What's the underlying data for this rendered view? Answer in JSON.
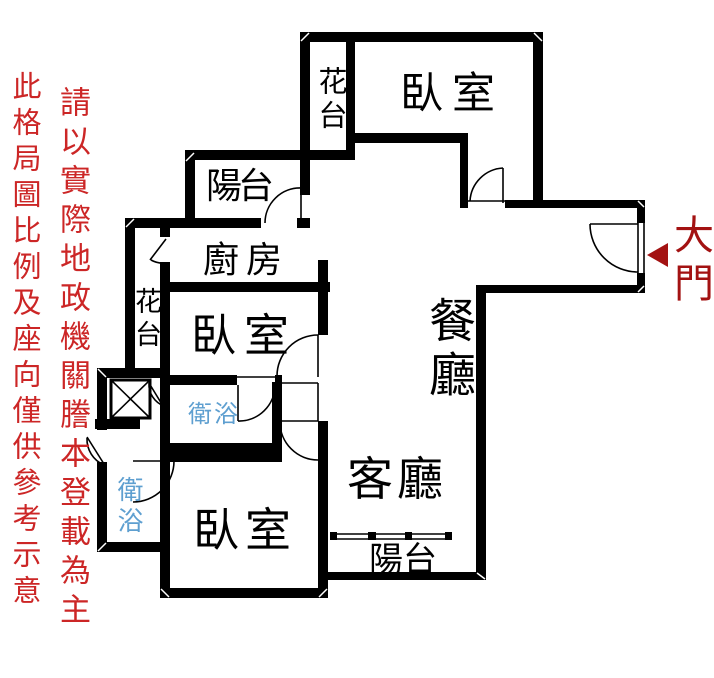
{
  "canvas": {
    "width": 714,
    "height": 678,
    "background": "#ffffff"
  },
  "colors": {
    "wall": "#000000",
    "disclaimer_text": "#cc2626",
    "main_door_text": "#a31212",
    "bath_label": "#5e9fd0",
    "room_label": "#000000"
  },
  "disclaimers": {
    "line1": "此格局圖比例及座向僅供參考示意",
    "line2": "請以實際地政機關謄本登載為主"
  },
  "entrance": {
    "label": "大門",
    "arrow_icon": "left-triangle-arrow"
  },
  "fixtures": {
    "elevator_icon": "crossed-box-elevator-shaft",
    "sliding_door_icon": "double-line-sliding-door"
  },
  "rooms": {
    "bedroom_top": {
      "label": "臥室"
    },
    "bedroom_middle": {
      "label": "臥室"
    },
    "bedroom_bottom": {
      "label": "臥室"
    },
    "kitchen": {
      "label": "廚房"
    },
    "dining": {
      "label": "餐廳"
    },
    "living": {
      "label": "客廳"
    },
    "balcony_top": {
      "label": "陽台"
    },
    "balcony_bottom": {
      "label": "陽台"
    },
    "flower_bed_top": {
      "label": "花台"
    },
    "flower_bed_left": {
      "label": "花台"
    },
    "bathroom_upper": {
      "label": "衛浴"
    },
    "bathroom_lower": {
      "label": "衛浴"
    }
  }
}
